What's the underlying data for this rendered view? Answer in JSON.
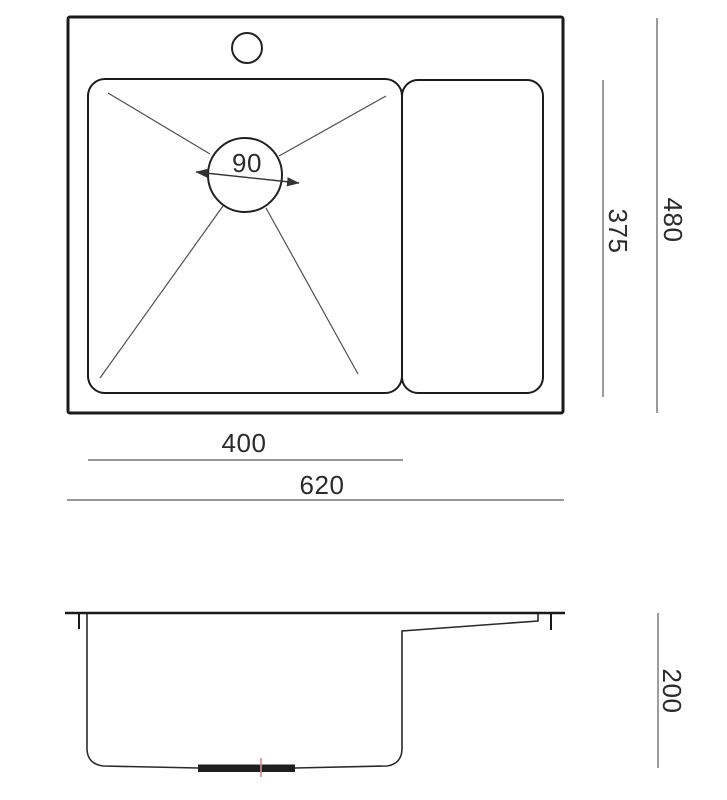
{
  "diagram": {
    "type": "technical-dimension-drawing",
    "subject": "kitchen sink with drainer, top view and side section view",
    "top_view": {
      "drain_diameter_label": "90",
      "basin_width_label": "400",
      "overall_width_label": "620",
      "basin_depth_label": "375",
      "overall_depth_label": "480"
    },
    "side_view": {
      "bowl_height_label": "200"
    },
    "colors": {
      "outline": "#1a1a1a",
      "thin_line": "#4f4f4f",
      "dimension_line": "#5a5a5a",
      "text": "#2b2b2b",
      "drain_centerline": "#d48a8a",
      "background": "#ffffff"
    }
  }
}
